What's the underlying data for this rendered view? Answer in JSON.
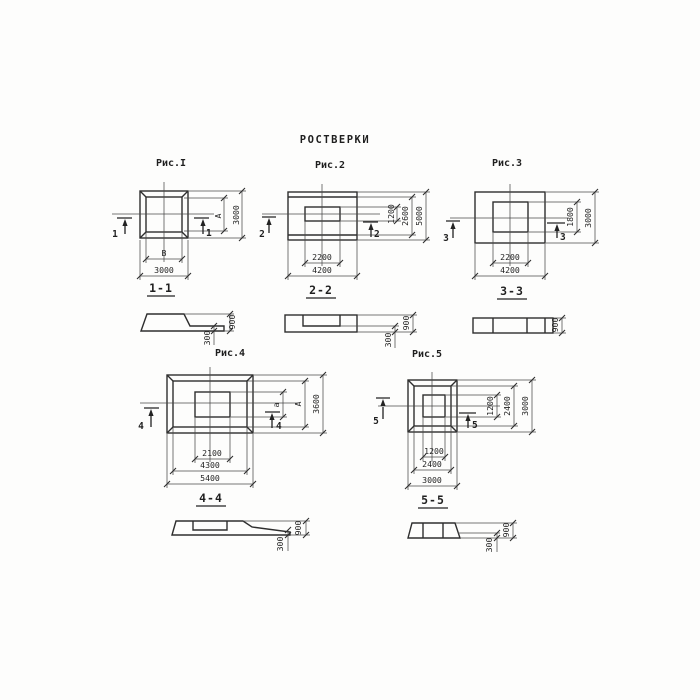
{
  "title": "РОСТВЕРКИ",
  "figures": [
    {
      "caption": "Рис.I",
      "cut_number": "1",
      "section_label": "1-1",
      "plan_dims": {
        "inner_width": "B",
        "outer_width": "3000",
        "inner_height": "A",
        "outer_height": "3000"
      },
      "section_dims": {
        "total_height": "900",
        "ledge": "300"
      }
    },
    {
      "caption": "Рис.2",
      "cut_number": "2",
      "section_label": "2-2",
      "plan_dims": {
        "inner_width": "2200",
        "outer_width": "4200",
        "inner_height": "1200",
        "mid_height": "2600",
        "outer_height": "5000"
      },
      "section_dims": {
        "total_height": "900",
        "ledge": "300"
      }
    },
    {
      "caption": "Рис.3",
      "cut_number": "3",
      "section_label": "3-3",
      "plan_dims": {
        "inner_width": "2200",
        "outer_width": "4200",
        "inner_height": "1800",
        "outer_height": "3000"
      },
      "section_dims": {
        "total_height": "900"
      }
    },
    {
      "caption": "Рис.4",
      "cut_number": "4",
      "section_label": "4-4",
      "plan_dims": {
        "inner_width": "2100",
        "mid_width": "4300",
        "outer_width": "5400",
        "inner_height": "a",
        "mid_height": "A",
        "outer_height": "3600"
      },
      "section_dims": {
        "total_height": "900",
        "ledge": "300"
      }
    },
    {
      "caption": "Рис.5",
      "cut_number": "5",
      "section_label": "5-5",
      "plan_dims": {
        "inner_width": "1200",
        "mid_width": "2400",
        "outer_width": "3000",
        "inner_height": "1200",
        "mid_height": "2400",
        "outer_height": "3000"
      },
      "section_dims": {
        "total_height": "900",
        "ledge": "300"
      }
    }
  ]
}
